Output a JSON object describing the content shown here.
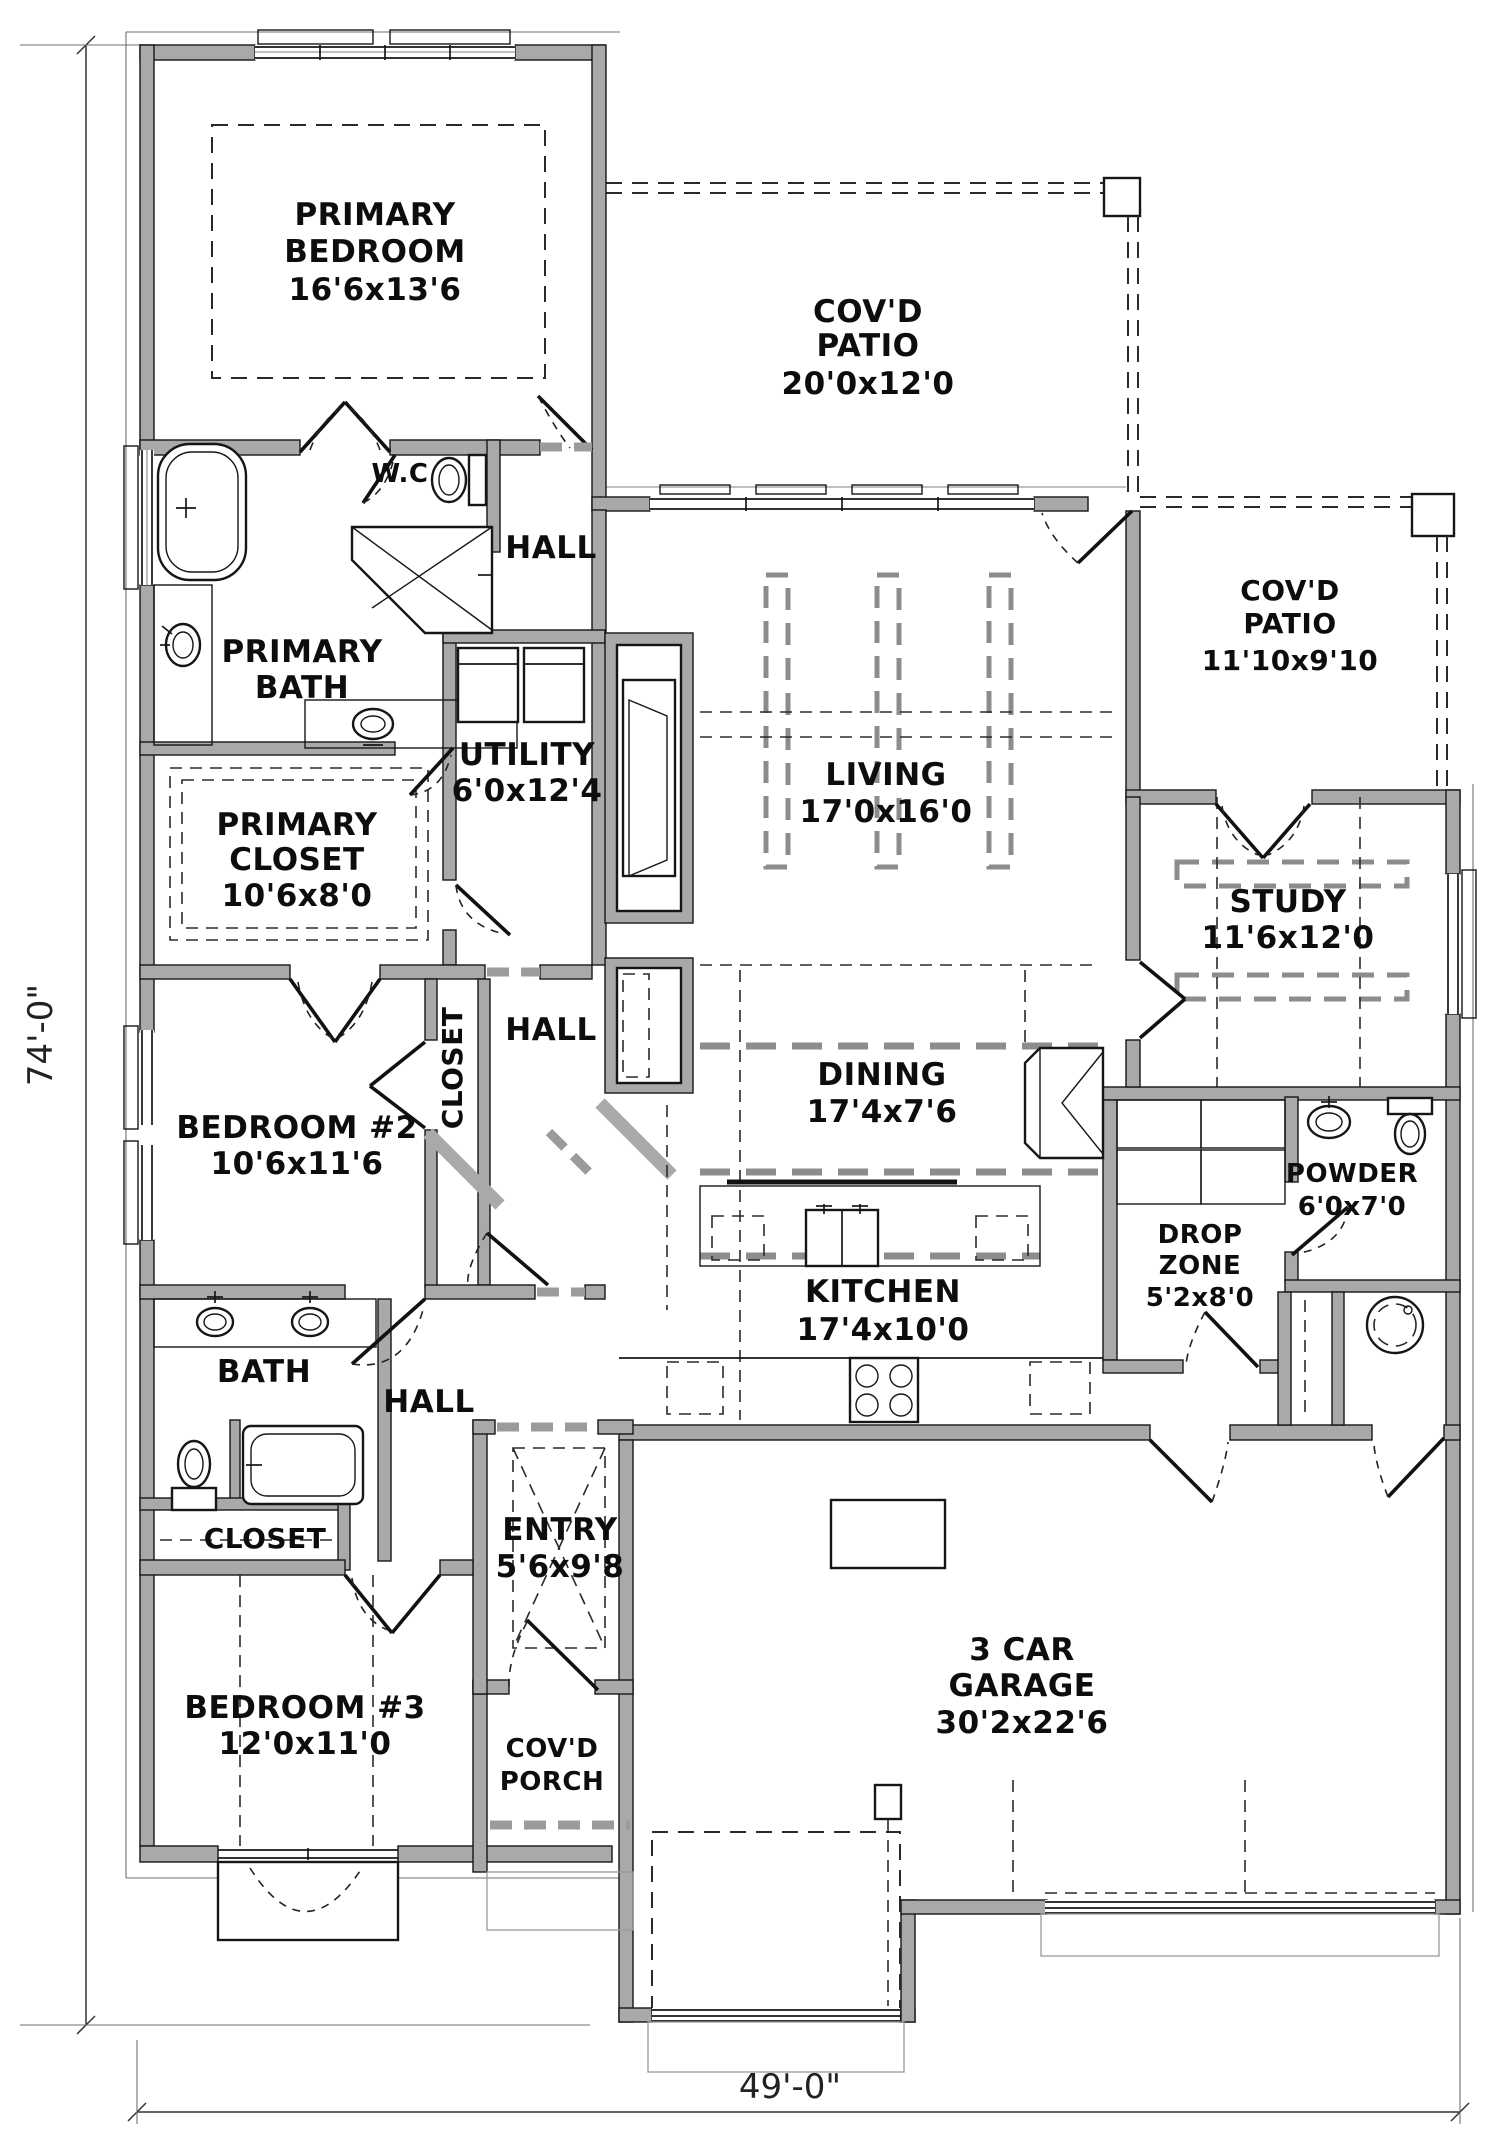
{
  "plan_type": "single-story house floor plan",
  "dims": {
    "height_label": "74'-0\"",
    "width_label": "49'-0\""
  },
  "rooms": {
    "primary_bedroom": {
      "lines": [
        "PRIMARY",
        "BEDROOM",
        "16'6x13'6"
      ]
    },
    "covd_patio_rear": {
      "lines": [
        "COV'D",
        "PATIO",
        "20'0x12'0"
      ]
    },
    "covd_patio_side": {
      "lines": [
        "COV'D",
        "PATIO",
        "11'10x9'10"
      ]
    },
    "wc": {
      "lines": [
        "W.C"
      ]
    },
    "hall_upper": {
      "lines": [
        "HALL"
      ]
    },
    "primary_bath": {
      "lines": [
        "PRIMARY",
        "BATH"
      ]
    },
    "utility": {
      "lines": [
        "UTILITY",
        "6'0x12'4"
      ]
    },
    "living": {
      "lines": [
        "LIVING",
        "17'0x16'0"
      ]
    },
    "primary_closet": {
      "lines": [
        "PRIMARY",
        "CLOSET",
        "10'6x8'0"
      ]
    },
    "study": {
      "lines": [
        "STUDY",
        "11'6x12'0"
      ]
    },
    "closet_mid": {
      "lines": [
        "CLOSET"
      ]
    },
    "hall_mid": {
      "lines": [
        "HALL"
      ]
    },
    "bedroom2": {
      "lines": [
        "BEDROOM #2",
        "10'6x11'6"
      ]
    },
    "dining": {
      "lines": [
        "DINING",
        "17'4x7'6"
      ]
    },
    "powder": {
      "lines": [
        "POWDER",
        "6'0x7'0"
      ]
    },
    "drop_zone": {
      "lines": [
        "DROP",
        "ZONE",
        "5'2x8'0"
      ]
    },
    "bath2": {
      "lines": [
        "BATH"
      ]
    },
    "hall_lower": {
      "lines": [
        "HALL"
      ]
    },
    "kitchen": {
      "lines": [
        "KITCHEN",
        "17'4x10'0"
      ]
    },
    "closet_lower": {
      "lines": [
        "CLOSET"
      ]
    },
    "entry": {
      "lines": [
        "ENTRY",
        "5'6x9'8"
      ]
    },
    "bedroom3": {
      "lines": [
        "BEDROOM #3",
        "12'0x11'0"
      ]
    },
    "covd_porch": {
      "lines": [
        "COV'D",
        "PORCH"
      ]
    },
    "garage": {
      "lines": [
        "3 CAR",
        "GARAGE",
        "30'2x22'6"
      ]
    }
  },
  "fixtures": [
    "soaking-tub",
    "neo-angle-shower",
    "toilet",
    "double-vanity",
    "washer",
    "dryer",
    "kitchen-island-sink",
    "cooktop-4-burner",
    "bath-tub",
    "pedestal-sink",
    "water-heater",
    "drop-zone-cubbies",
    "fireplace",
    "dining-hutch",
    "garage-equipment-pad"
  ],
  "colors": {
    "wall_fill": "#a9a9a9",
    "line": "#161616",
    "beam_gray": "#8c8c8c",
    "background": "#ffffff"
  }
}
